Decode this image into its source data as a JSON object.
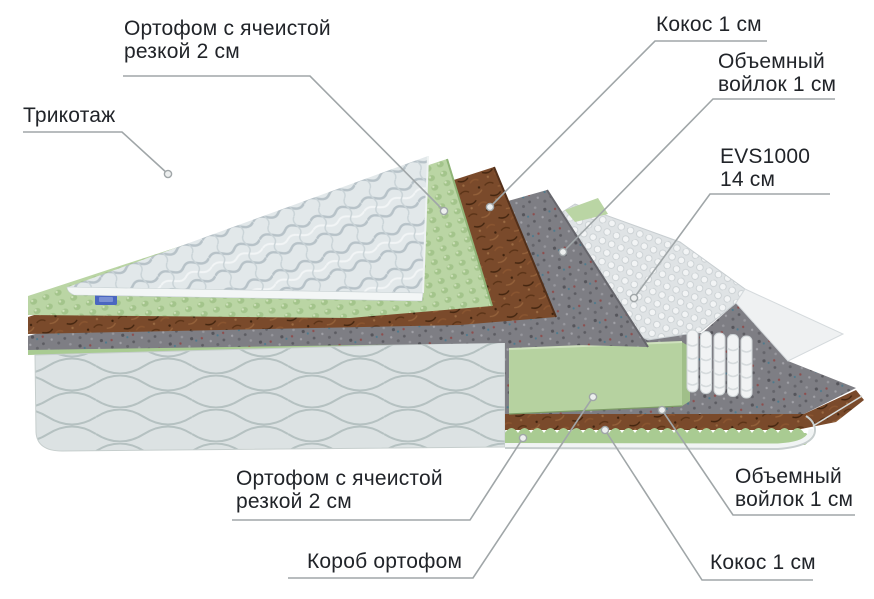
{
  "title": "Мattress layers cutaway diagram",
  "colors": {
    "background": "#ffffff",
    "text": "#212429",
    "leader_line": "#a0a6a8",
    "dot_fill": "#edefef",
    "quilt": "#e2e8ea",
    "quilt_wave": "#b7c2c8",
    "piping": "#f3f6f6",
    "green_foam": "#bad5a4",
    "green_foam_dark": "#8fb477",
    "green_zigzag": "#a9cb92",
    "coir": "#7a4a2b",
    "coir_dark": "#53301a",
    "felt": "#7e7e84",
    "felt_dark": "#66666c",
    "springs_bg": "#dfe3e5",
    "springs_bubble": "#f2f4f5",
    "base_fabric": "#dce2e3",
    "base_wave": "#b5c1c1",
    "slab": "#b6d2a0",
    "slab_side": "#a0bf89",
    "rim": "#f1f4f4",
    "rim_stroke": "#c7cece",
    "tag_blue": "#4a66c0",
    "tag_blue_light": "#7a90d4"
  },
  "labels": [
    {
      "id": "trikotazh",
      "lines": [
        "Трикотаж"
      ],
      "target": "layer-knit-cover",
      "leader": [
        [
          23,
          132
        ],
        [
          122,
          132
        ],
        [
          168,
          174
        ]
      ],
      "dot": [
        168,
        174
      ]
    },
    {
      "id": "ortofom-top",
      "lines": [
        "Ортофом с ячеистой",
        "резкой 2 см"
      ],
      "target": "layer-egg-foam-top",
      "leader": [
        [
          123,
          76
        ],
        [
          310,
          76
        ],
        [
          444,
          211
        ]
      ],
      "dot": [
        444,
        211
      ]
    },
    {
      "id": "kokos-top",
      "lines": [
        "Кокос 1 см"
      ],
      "target": "layer-coir-top",
      "leader": [
        [
          767,
          41
        ],
        [
          655,
          41
        ],
        [
          490,
          207
        ]
      ],
      "dot": [
        490,
        207
      ]
    },
    {
      "id": "voilok-top",
      "lines": [
        "Объемный",
        "войлок 1 см"
      ],
      "target": "layer-felt-top",
      "leader": [
        [
          835,
          99
        ],
        [
          713,
          99
        ],
        [
          563,
          252
        ]
      ],
      "dot": [
        563,
        252
      ]
    },
    {
      "id": "evs",
      "lines": [
        "EVS1000",
        "14 см"
      ],
      "target": "layer-spring-block",
      "leader": [
        [
          830,
          194
        ],
        [
          710,
          194
        ],
        [
          634,
          298
        ]
      ],
      "dot": [
        634,
        298
      ]
    },
    {
      "id": "ortofom-bottom",
      "lines": [
        "Ортофом с ячеистой",
        "резкой 2 см"
      ],
      "target": "cutaway-egg-foam-zigzag",
      "leader": [
        [
          232,
          520
        ],
        [
          470,
          520
        ],
        [
          523,
          438
        ]
      ],
      "dot": [
        523,
        438
      ]
    },
    {
      "id": "korob",
      "lines": [
        "Короб ортофом"
      ],
      "target": "cutaway-foam-box-slab",
      "leader": [
        [
          288,
          578
        ],
        [
          473,
          578
        ],
        [
          593,
          397
        ]
      ],
      "dot": [
        593,
        397
      ]
    },
    {
      "id": "voilok-bottom",
      "lines": [
        "Объемный",
        "войлок 1 см"
      ],
      "target": "cutaway-felt-floor",
      "leader": [
        [
          855,
          515
        ],
        [
          733,
          515
        ],
        [
          662,
          410
        ]
      ],
      "dot": [
        662,
        410
      ]
    },
    {
      "id": "kokos-bottom",
      "lines": [
        "Кокос 1 см"
      ],
      "target": "cutaway-coir-strip",
      "leader": [
        [
          813,
          580
        ],
        [
          702,
          580
        ],
        [
          605,
          430
        ]
      ],
      "dot": [
        605,
        430
      ]
    }
  ]
}
